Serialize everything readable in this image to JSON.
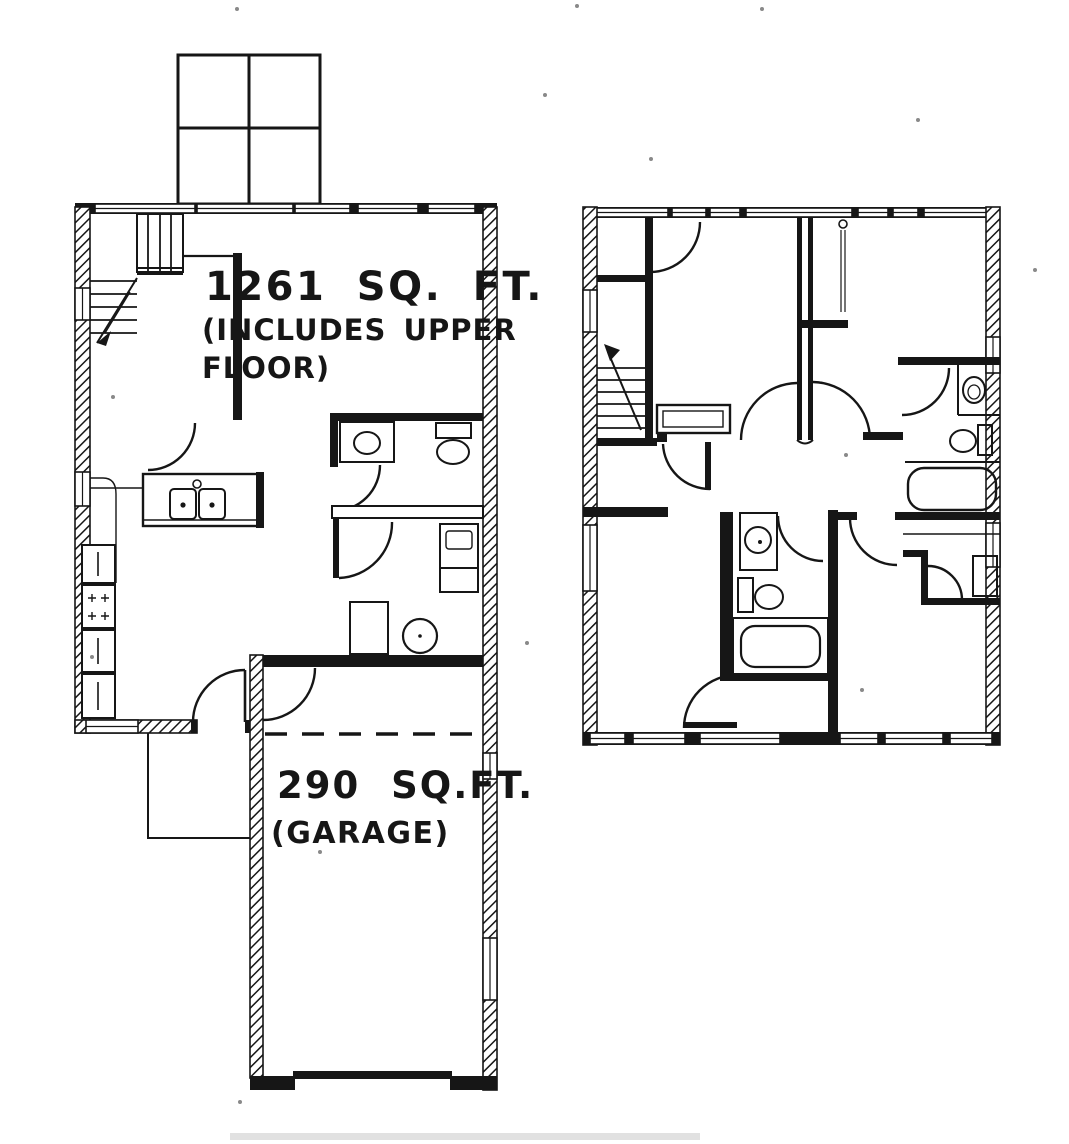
{
  "document": {
    "kind": "scanned floor plan drawing",
    "colors": {
      "ink": "#161616",
      "paper": "#ffffff"
    }
  },
  "floor_plans": {
    "main_floor": {
      "area_text": "1261 SQ. FT.",
      "area_note_line1": "(INCLUDES UPPER",
      "area_note_line2": "FLOOR)",
      "fixtures": [
        "stairs",
        "kitchen-double-sink",
        "range",
        "refrigerator",
        "cabinets",
        "bathroom-sink",
        "toilet",
        "washer-dryer",
        "water-heater",
        "entry-door",
        "deck",
        "porch"
      ]
    },
    "garage": {
      "area_text": "290 SQ.FT.",
      "label_text": "(GARAGE)",
      "fixtures": [
        "garage-door-opening",
        "service-door",
        "dashed-ceiling-line"
      ]
    },
    "upper_floor": {
      "fixtures": [
        "stairs",
        "hall-bathroom-sink",
        "hall-toilet",
        "hall-bathtub",
        "master-bathroom-sink",
        "master-toilet",
        "master-bathtub",
        "closets",
        "bedroom-doors"
      ]
    }
  }
}
